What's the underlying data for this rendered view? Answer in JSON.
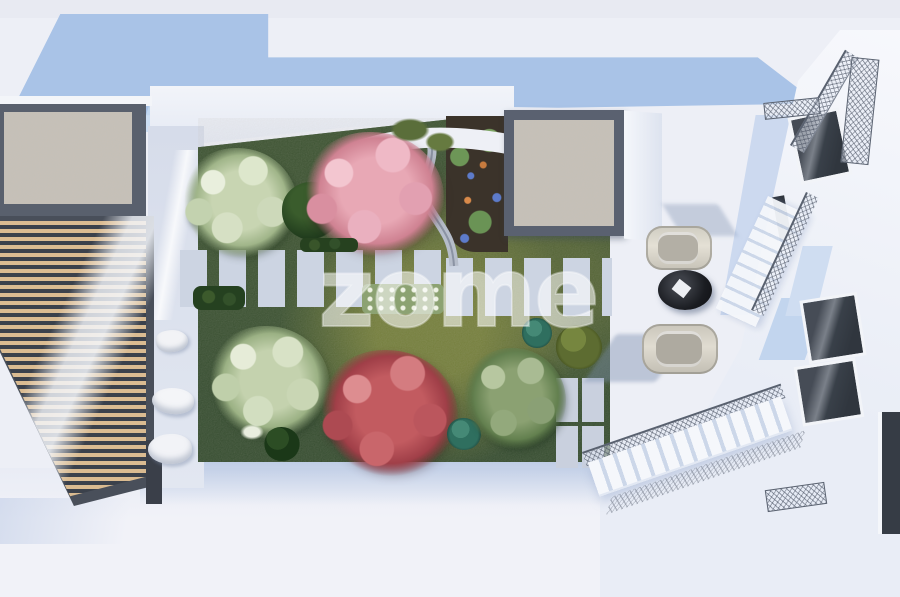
{
  "watermark": {
    "text": "zome",
    "color": "#ffffff",
    "opacity": 0.45
  },
  "scene": {
    "description": "Top-down architectural render of a courtyard garden between two modern buildings",
    "palette": {
      "shadow_blue": "#a9c3e7",
      "ground": "#edeff6",
      "terrace": "#eff1f8",
      "garden_green_dark": "#2c4526",
      "garden_green_light": "#6e7a34",
      "pale_tree": "#ccd8bc",
      "pink_tree": "#e8a8b5",
      "red_tree": "#c25b60",
      "teal_shrub": "#2f6f5f",
      "paver_stone": "#ccd4e2",
      "gravel_beige": "#c7c0b4",
      "wood_slat": "#d9ba90",
      "frame_dark": "#4c535e",
      "building_white": "#f5f6fb",
      "window_glass": "#3e444d",
      "wall_blue": "#c2d5ee",
      "car_body": "#d8d4c9"
    },
    "elements": {
      "left_roof": "gravel roof strip",
      "pergola": "slatted wooden pergola",
      "patio": "side patio with lounge chairs",
      "garden": "central lawn with trees and stepping stones",
      "flowerbed": "mulched flower bed with curved path",
      "gravel_skylight": "square gravel roof panel",
      "driveway": "parking court with two cars",
      "right_building": "white building with glass windows and stairs"
    }
  }
}
